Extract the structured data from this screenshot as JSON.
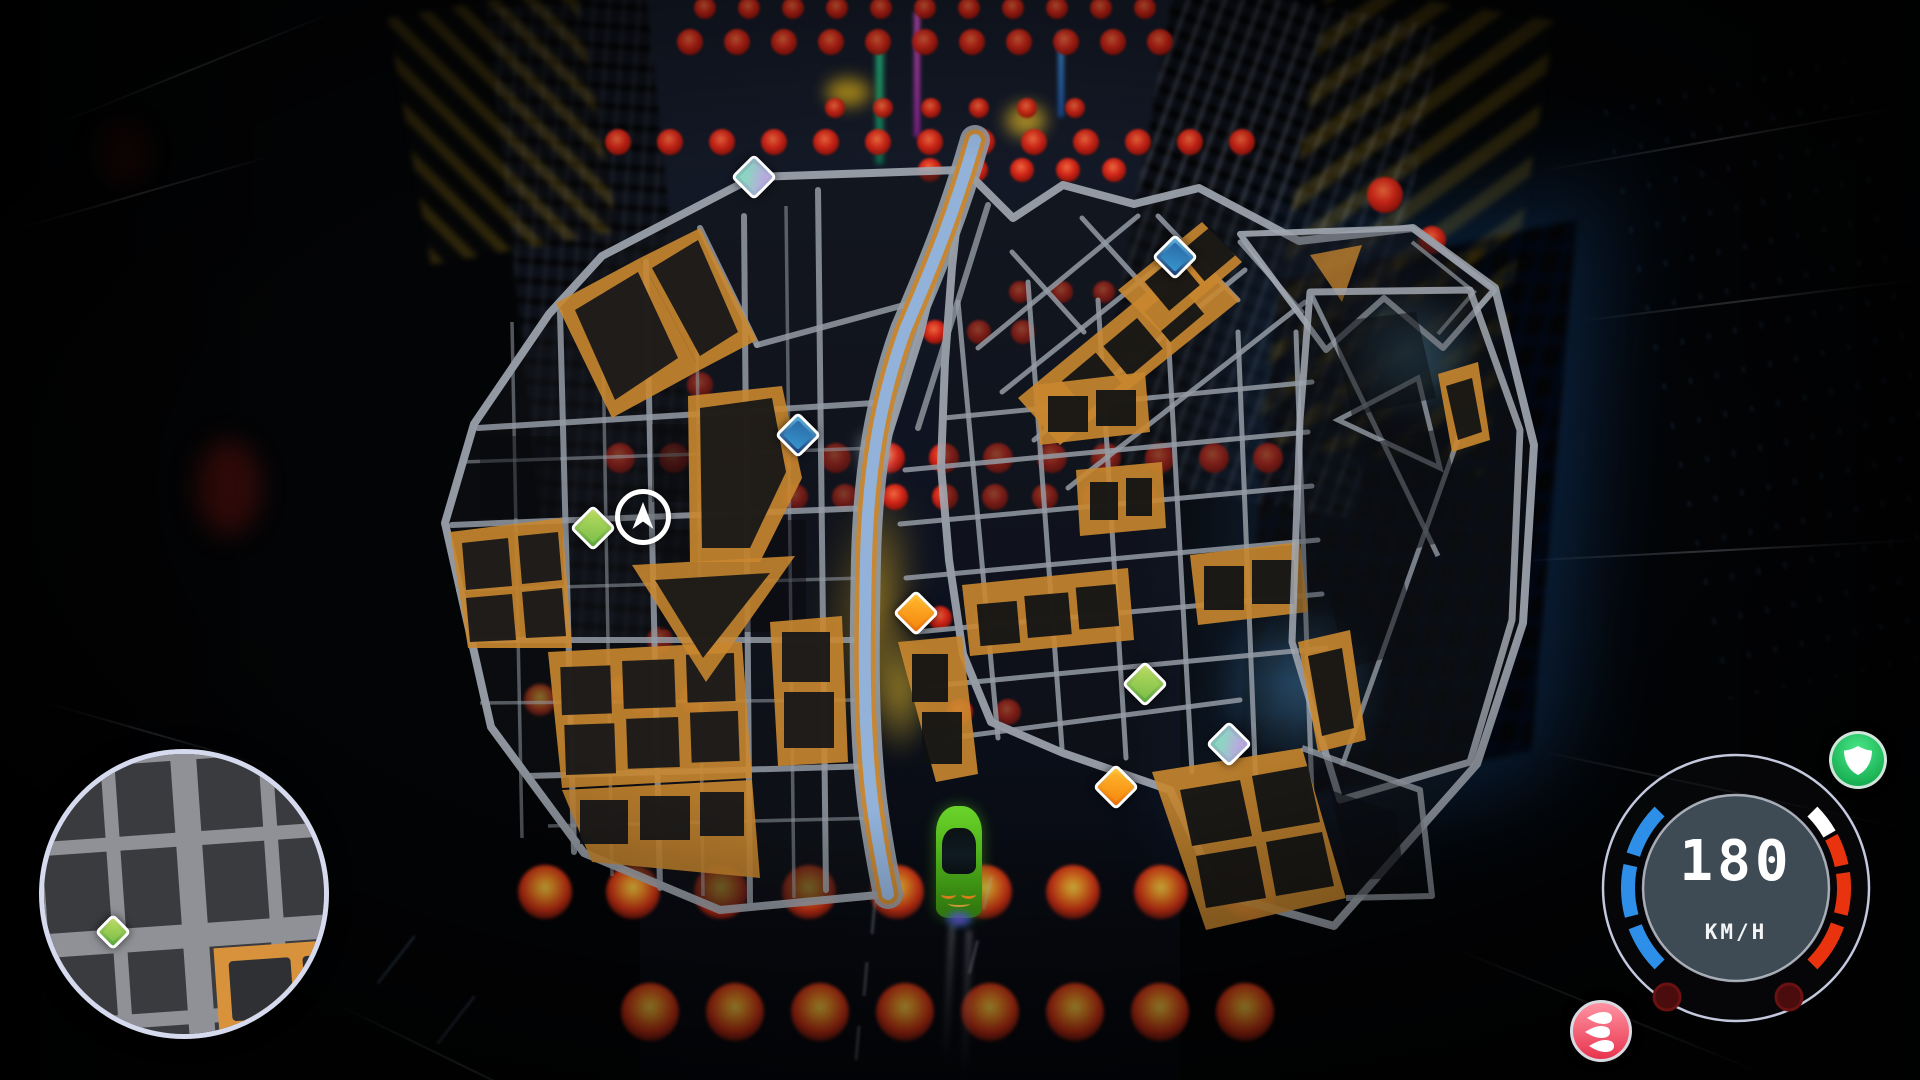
{
  "game_hud": {
    "speedometer": {
      "value": "180",
      "unit": "KM/H",
      "accent_blue": "#2e8fe8",
      "accent_red": "#e8330e",
      "accent_white": "#ffffff",
      "dial_fill": "#3e4b55"
    },
    "shield_badge": {
      "name": "shield",
      "color": "#22c868"
    },
    "nitro_badge": {
      "name": "nitro",
      "color": "#e8344e"
    }
  },
  "world_map": {
    "player_indicator": {
      "x": 643,
      "y": 517
    },
    "markers": [
      {
        "x": 754,
        "y": 177,
        "type": "teal"
      },
      {
        "x": 1175,
        "y": 257,
        "type": "blue"
      },
      {
        "x": 798,
        "y": 435,
        "type": "blue"
      },
      {
        "x": 593,
        "y": 528,
        "type": "green"
      },
      {
        "x": 916,
        "y": 613,
        "type": "orange"
      },
      {
        "x": 1145,
        "y": 684,
        "type": "green"
      },
      {
        "x": 1229,
        "y": 744,
        "type": "teal"
      },
      {
        "x": 1116,
        "y": 787,
        "type": "orange"
      }
    ],
    "colors": {
      "street": "#949BA4",
      "district_orange": "#C9872F",
      "main_road_blue": "#8FB4E4"
    }
  },
  "minimap": {
    "player": {
      "x": 145,
      "y": 140,
      "color": "#F6A51F"
    },
    "markers": [
      {
        "x": 69,
        "y": 178,
        "type": "green"
      }
    ]
  },
  "scene": {
    "car_color": "#57C41E",
    "lantern_rows": [
      {
        "y": 8,
        "x0": 705,
        "x1": 1145,
        "step": 44,
        "r": 11
      },
      {
        "y": 42,
        "x0": 690,
        "x1": 1160,
        "step": 47,
        "r": 13
      },
      {
        "y": 108,
        "x0": 835,
        "x1": 1075,
        "step": 48,
        "r": 10
      },
      {
        "y": 142,
        "x0": 618,
        "x1": 1290,
        "step": 52,
        "r": 13
      },
      {
        "y": 170,
        "x0": 930,
        "x1": 1115,
        "step": 46,
        "r": 12
      },
      {
        "y": 292,
        "x0": 1020,
        "x1": 1105,
        "step": 42,
        "r": 11
      },
      {
        "y": 332,
        "x0": 935,
        "x1": 1025,
        "step": 44,
        "r": 12
      },
      {
        "y": 458,
        "x0": 620,
        "x1": 1275,
        "step": 54,
        "r": 15
      },
      {
        "y": 497,
        "x0": 795,
        "x1": 1165,
        "step": 50,
        "r": 13
      },
      {
        "y": 618,
        "x0": 940,
        "x1": 990,
        "step": 46,
        "r": 12
      },
      {
        "y": 700,
        "x0": 540,
        "x1": 700,
        "step": 52,
        "r": 16,
        "glow": true
      },
      {
        "y": 712,
        "x0": 960,
        "x1": 1012,
        "step": 48,
        "r": 13
      },
      {
        "y": 892,
        "x0": 545,
        "x1": 1250,
        "step": 88,
        "r": 27,
        "glow": true
      },
      {
        "y": 1012,
        "x0": 650,
        "x1": 1255,
        "step": 85,
        "r": 29,
        "glow": true
      }
    ],
    "lanterns_single": [
      {
        "x": 1385,
        "y": 195,
        "r": 18
      },
      {
        "x": 1432,
        "y": 240,
        "r": 14
      },
      {
        "x": 700,
        "y": 385,
        "r": 13
      },
      {
        "x": 745,
        "y": 420,
        "r": 12
      },
      {
        "x": 1060,
        "y": 420,
        "r": 12
      },
      {
        "x": 1105,
        "y": 395,
        "r": 11
      },
      {
        "x": 660,
        "y": 640,
        "r": 13
      },
      {
        "x": 620,
        "y": 690,
        "r": 14,
        "glow": true
      }
    ]
  }
}
